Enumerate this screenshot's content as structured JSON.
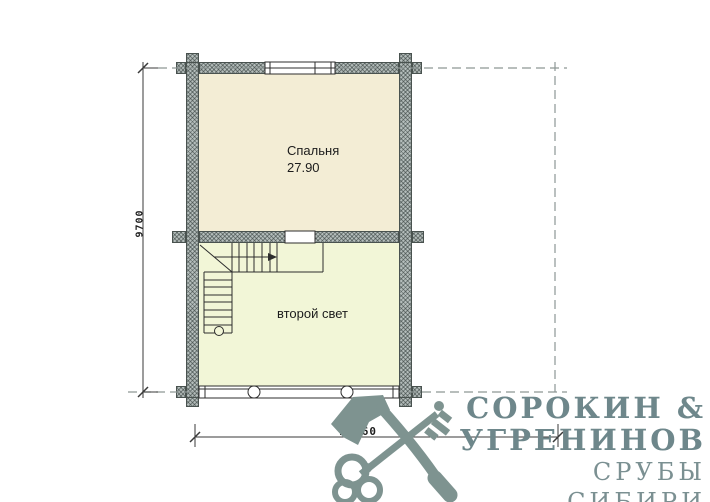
{
  "plan": {
    "rooms": [
      {
        "label": "Спальня",
        "area": "27.90"
      },
      {
        "label": "второй свет"
      }
    ],
    "dimensions": {
      "width": "10760",
      "height": "9700"
    }
  },
  "logo": {
    "name_line1": "СОРОКИН &",
    "name_line2": "УГРЕНИНОВ",
    "tagline": "СРУБЫ СИБИРИ",
    "icon": "axe-key-icon"
  },
  "colors": {
    "bedroom_fill": "#f3edd5",
    "second_light_fill": "#f2f6d7",
    "wall_fill": "#b4bdbb",
    "line": "#2d2d2d",
    "axis_dash": "#8d9695",
    "logo": "#7e9390"
  }
}
